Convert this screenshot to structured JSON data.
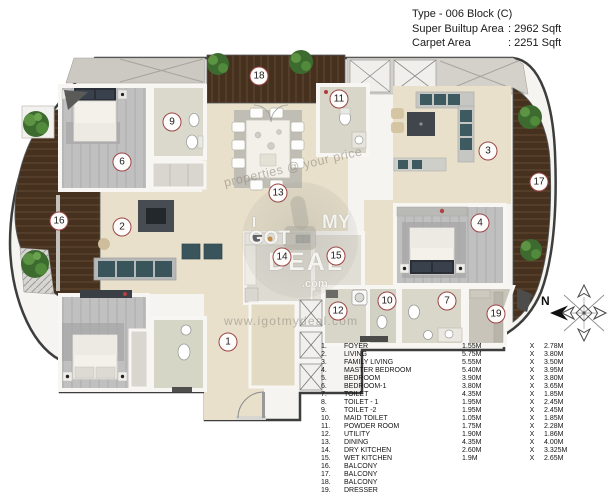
{
  "header": {
    "line1": "Type - 006 Block (C)",
    "line2_label": "Super Builtup Area",
    "line2_value": ": 2962 Sqft",
    "line3_label": "Carpet Area",
    "line3_value": ": 2251 Sqft"
  },
  "plan": {
    "north_label": "N",
    "watermarks": {
      "tagline": "properties @ your price",
      "url": "www.igotmydeal.com",
      "logo": {
        "i": "I",
        "got": "GOT",
        "my": "MY",
        "deal": "DEAL",
        "com": ".com"
      }
    },
    "markers": [
      {
        "n": "1",
        "x": 228,
        "y": 342
      },
      {
        "n": "2",
        "x": 122,
        "y": 227
      },
      {
        "n": "3",
        "x": 488,
        "y": 151
      },
      {
        "n": "4",
        "x": 480,
        "y": 223
      },
      {
        "n": "6",
        "x": 122,
        "y": 162
      },
      {
        "n": "7",
        "x": 447,
        "y": 301
      },
      {
        "n": "9",
        "x": 172,
        "y": 122
      },
      {
        "n": "10",
        "x": 387,
        "y": 301
      },
      {
        "n": "11",
        "x": 339,
        "y": 99
      },
      {
        "n": "12",
        "x": 338,
        "y": 311
      },
      {
        "n": "13",
        "x": 278,
        "y": 193
      },
      {
        "n": "14",
        "x": 282,
        "y": 257
      },
      {
        "n": "15",
        "x": 336,
        "y": 256
      },
      {
        "n": "16",
        "x": 59,
        "y": 221
      },
      {
        "n": "17",
        "x": 539,
        "y": 182
      },
      {
        "n": "18",
        "x": 259,
        "y": 76
      },
      {
        "n": "19",
        "x": 496,
        "y": 314
      }
    ]
  },
  "legend": {
    "rows": [
      {
        "num": "1.",
        "name": "FOYER",
        "d1": "1.55M",
        "x": "X",
        "d2": "2.78M"
      },
      {
        "num": "2.",
        "name": "LIVING",
        "d1": "5.75M",
        "x": "X",
        "d2": "3.80M"
      },
      {
        "num": "3.",
        "name": "FAMILY LIVING",
        "d1": "5.55M",
        "x": "X",
        "d2": "3.50M"
      },
      {
        "num": "4.",
        "name": "MASTER BEDROOM",
        "d1": "5.40M",
        "x": "X",
        "d2": "3.95M"
      },
      {
        "num": "5.",
        "name": "BEDROOM",
        "d1": "3.90M",
        "x": "X",
        "d2": "3.80M"
      },
      {
        "num": "6.",
        "name": "BEDROOM-1",
        "d1": "3.80M",
        "x": "X",
        "d2": "3.65M"
      },
      {
        "num": "7.",
        "name": "TOILET",
        "d1": "4.35M",
        "x": "X",
        "d2": "1.85M"
      },
      {
        "num": "8.",
        "name": "TOILET - 1",
        "d1": "1.95M",
        "x": "X",
        "d2": "2.45M"
      },
      {
        "num": "9.",
        "name": "TOILET -2",
        "d1": "1.95M",
        "x": "X",
        "d2": "2.45M"
      },
      {
        "num": "10.",
        "name": "MAID TOILET",
        "d1": "1.05M",
        "x": "X",
        "d2": "1.85M"
      },
      {
        "num": "11.",
        "name": "POWDER ROOM",
        "d1": "1.75M",
        "x": "X",
        "d2": "2.28M"
      },
      {
        "num": "12.",
        "name": "UTILITY",
        "d1": "1.90M",
        "x": "X",
        "d2": "1.86M"
      },
      {
        "num": "13.",
        "name": "DINING",
        "d1": "4.35M",
        "x": "X",
        "d2": "4.00M"
      },
      {
        "num": "14.",
        "name": "DRY KITCHEN",
        "d1": "2.60M",
        "x": "X",
        "d2": "3.325M"
      },
      {
        "num": "15.",
        "name": "WET KITCHEN",
        "d1": "1.9M",
        "x": "X",
        "d2": "2.65M"
      },
      {
        "num": "16.",
        "name": "BALCONY",
        "d1": "",
        "x": "",
        "d2": ""
      },
      {
        "num": "17.",
        "name": "BALCONY",
        "d1": "",
        "x": "",
        "d2": ""
      },
      {
        "num": "18.",
        "name": "BALCONY",
        "d1": "",
        "x": "",
        "d2": ""
      },
      {
        "num": "19.",
        "name": "DRESSER",
        "d1": "",
        "x": "",
        "d2": ""
      }
    ]
  },
  "colors": {
    "marker_border": "#9c4444",
    "marble": "#e8e0cb",
    "bedroom_floor": "#c0c0c0",
    "balcony_wood": "#46311f",
    "wall": "#f7f6f3"
  }
}
